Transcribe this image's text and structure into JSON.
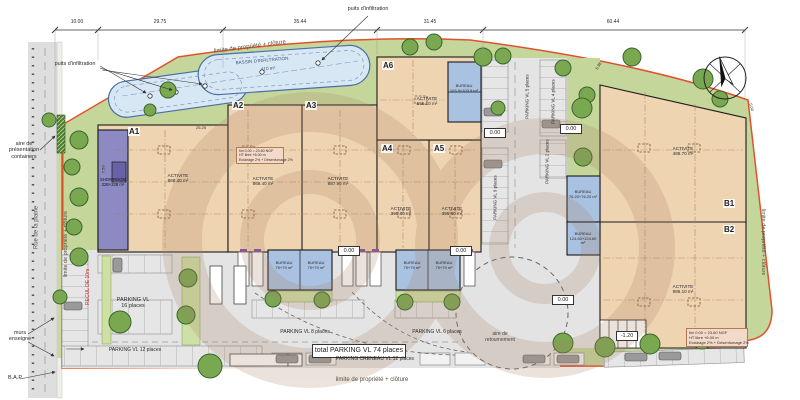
{
  "boundary": {
    "label": "limite de propriété + clôture"
  },
  "dimensions": {
    "top": [
      "10.00",
      "29.75",
      "35.44",
      "31.45",
      "60.44"
    ],
    "a1_width": "25.25",
    "a1_height": "7.50",
    "b_right": "5.00",
    "b_top": "5.98"
  },
  "basin": {
    "title": "BASSIN D'INFILTRATION",
    "area": "410 m²",
    "well_label": "puits d'infiltration"
  },
  "street": {
    "name": "Rue de la plaine",
    "presentation_area": "aire de\nprésentation\ncontainers",
    "sign_wall": "murs\nenseigne",
    "bap": "B.A.P",
    "setback": "RECUL DE 10m"
  },
  "units": {
    "a1": {
      "code": "A1",
      "use": "ACTIVITE",
      "area": "868.40 m²"
    },
    "a2": {
      "code": "A2",
      "use": "ACTIVITE",
      "area": "868.40 m²"
    },
    "a3": {
      "code": "A3",
      "use": "ACTIVITE",
      "area": "887.95 m²"
    },
    "a4": {
      "code": "A4",
      "use": "ACTIVITE",
      "area": "395.80 m²"
    },
    "a5": {
      "code": "A5",
      "use": "ACTIVITE",
      "area": "395.80 m²"
    },
    "a6": {
      "code": "A6",
      "use": "ACTIVITE",
      "area": "555.10 m²"
    },
    "b1": {
      "code": "B1",
      "use": "ACTIVITE",
      "area": "486.70 m²"
    },
    "b2": {
      "code": "B2",
      "use": "ACTIVITE",
      "area": "986.10 m²"
    }
  },
  "showroom": {
    "label": "SHOWROOM",
    "area": "228+228 m²"
  },
  "offices": {
    "a6": {
      "label": "BUREAU",
      "area": "103.9+103.9 m²"
    },
    "row": {
      "label": "BUREAU",
      "area": "79+79 m²"
    },
    "b_upper": {
      "label": "BUREAU",
      "area": "76.20+76.20 m²"
    },
    "b_lower": {
      "label": "BUREAU",
      "area": "124.60+124.60 m²"
    }
  },
  "notes": {
    "line1": "fini 0.00 = 23.60 NGF",
    "line2": "HT libre +6.00 m",
    "line3": "Eclairage 2% + Désenfumage 2%"
  },
  "parking": {
    "p16": "PARKING VL\n16 places",
    "p12": "PARKING VL 12 places",
    "p8": "PARKING VL 8 places",
    "p6": "PARKING VL 6 places",
    "p5": "PARKING VL 5 places",
    "p4": "PARKING VL 4 places",
    "p9": "PARKING VL 9 places",
    "p2": "PARKING VL 2 places",
    "total": "total PARKING VL 74 places",
    "creneau": "PARKING CRENEAU VL 12 places"
  },
  "site": {
    "turning_area": "aire de\nretournement"
  },
  "levels": {
    "zero": "0.00",
    "minus": "-1.20"
  },
  "colors": {
    "green": "#c5d69b",
    "building": "#efd4b2",
    "office_blue": "#a9c2e2",
    "showroom_purple": "#8d89c2",
    "basin_blue": "#d8e7f4",
    "boundary_red": "#e0512d",
    "asphalt": "#e4e4e4",
    "tree": "#79a851"
  }
}
